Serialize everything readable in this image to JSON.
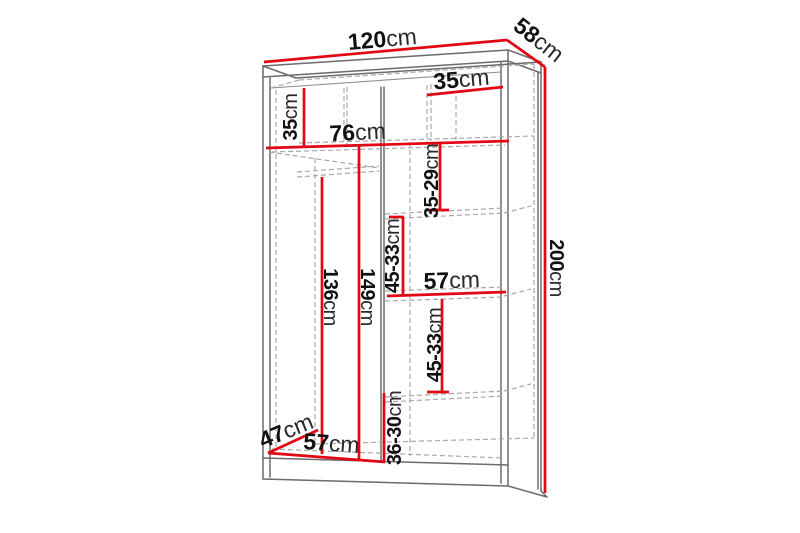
{
  "diagram": {
    "unit": "cm",
    "colors": {
      "dimension_red": "#e30613",
      "outline_gray": "#6b6b6b",
      "hidden_gray": "#a8a8a8",
      "text_black": "#111111",
      "background": "#ffffff"
    },
    "dimensions": {
      "width": {
        "value": "120",
        "unit": "cm"
      },
      "depth": {
        "value": "58",
        "unit": "cm"
      },
      "height": {
        "value": "200",
        "unit": "cm"
      },
      "top_left_compartment_height": {
        "value": "35",
        "unit": "cm"
      },
      "left_section_width": {
        "value": "76",
        "unit": "cm"
      },
      "top_right_shelf_width": {
        "value": "35",
        "unit": "cm"
      },
      "right_top_compartment_height": {
        "value": "35-29",
        "unit": "cm"
      },
      "left_inner_height_front": {
        "value": "136",
        "unit": "cm"
      },
      "left_inner_height_back": {
        "value": "149",
        "unit": "cm"
      },
      "right_upper_compartment_height": {
        "value": "45-33",
        "unit": "cm"
      },
      "right_section_width": {
        "value": "57",
        "unit": "cm"
      },
      "right_lower_compartment_height": {
        "value": "45-33",
        "unit": "cm"
      },
      "right_bottom_compartment_height": {
        "value": "36-30",
        "unit": "cm"
      },
      "interior_depth": {
        "value": "47",
        "unit": "cm"
      },
      "bottom_left_section_width": {
        "value": "57",
        "unit": "cm"
      }
    }
  }
}
